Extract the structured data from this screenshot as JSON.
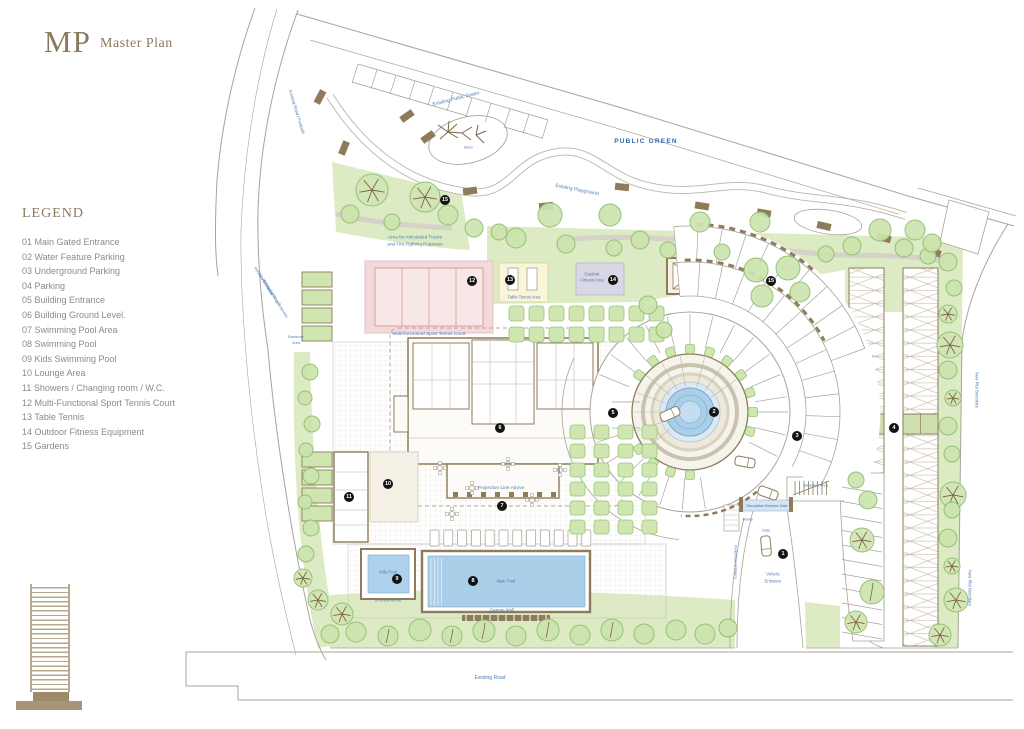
{
  "header": {
    "logo": "MP",
    "title": "Master Plan"
  },
  "legend": {
    "title": "LEGEND",
    "items": [
      "01 Main Gated Entrance",
      "02 Water Feature Parking",
      "03 Underground Parking",
      "04 Parking",
      "05 Building Entrance",
      "06 Building Ground Level.",
      "07 Swimming Pool Area",
      "08 Swimming Pool",
      "09 Kids Swimming Pool",
      "10 Lounge Area",
      "11 Showers / Changing room / W.C.",
      "12 Multi-Functional Sport Tennis Court",
      "13 Table Tennis",
      "14 Outdoor Fitness Equipment",
      "15 Gardens"
    ]
  },
  "colors": {
    "brand_brown": "#8a7a5f",
    "label_blue": "#4f7cb5",
    "public_green_blue": "#2f6aa8",
    "garden_green": "#dcebc4",
    "pool_blue": "#a9cfe9",
    "court_pink": "#f3d9d9",
    "wall_brown": "#8d7b5a"
  },
  "plan": {
    "markers": [
      {
        "n": "1",
        "x": 783,
        "y": 554
      },
      {
        "n": "2",
        "x": 714,
        "y": 412
      },
      {
        "n": "3",
        "x": 797,
        "y": 436
      },
      {
        "n": "4",
        "x": 894,
        "y": 428
      },
      {
        "n": "5",
        "x": 613,
        "y": 413
      },
      {
        "n": "6",
        "x": 500,
        "y": 428
      },
      {
        "n": "7",
        "x": 502,
        "y": 506
      },
      {
        "n": "8",
        "x": 473,
        "y": 581
      },
      {
        "n": "9",
        "x": 397,
        "y": 579
      },
      {
        "n": "10",
        "x": 388,
        "y": 484
      },
      {
        "n": "11",
        "x": 349,
        "y": 497
      },
      {
        "n": "12",
        "x": 472,
        "y": 281
      },
      {
        "n": "13",
        "x": 510,
        "y": 280
      },
      {
        "n": "14",
        "x": 613,
        "y": 280
      },
      {
        "n": "15",
        "x": 445,
        "y": 200
      },
      {
        "n": "15",
        "x": 771,
        "y": 281
      }
    ],
    "labels": [
      {
        "t": "PUBLIC GREEN",
        "x": 646,
        "y": 142,
        "s": 6.5,
        "c": "#2f6aa8",
        "b": true,
        "ls": 1.2
      },
      {
        "t": "Existing Public Green",
        "x": 456,
        "y": 99,
        "s": 5,
        "r": -14
      },
      {
        "t": "Existing Playground",
        "x": 577,
        "y": 190,
        "s": 5,
        "r": 11
      },
      {
        "t": "Existing Road / Footpath",
        "x": 297,
        "y": 112,
        "s": 4.2,
        "r": 73
      },
      {
        "t": "Area for Articulated Trucks",
        "x": 415,
        "y": 237,
        "s": 4.6
      },
      {
        "t": "and Fire Fighting Purposes",
        "x": 415,
        "y": 244,
        "s": 4.6
      },
      {
        "t": "Vehicles Entrance",
        "x": 263,
        "y": 281,
        "s": 4,
        "r": 58
      },
      {
        "t": "for Articulated Trucks",
        "x": 269,
        "y": 290,
        "s": 4,
        "r": 58
      },
      {
        "t": "& Fire Fighting Purposes",
        "x": 275,
        "y": 299,
        "s": 4,
        "r": 58
      },
      {
        "t": "Multi-functional Sport Tennis Court",
        "x": 429,
        "y": 335,
        "s": 4.8
      },
      {
        "t": "Table Tennis Area",
        "x": 524,
        "y": 297,
        "s": 4.2
      },
      {
        "t": "Outdoor",
        "x": 592,
        "y": 274,
        "s": 4.2
      },
      {
        "t": "Fitness Area",
        "x": 592,
        "y": 280,
        "s": 4.2
      },
      {
        "t": "Projection Line Above",
        "x": 501,
        "y": 489,
        "s": 4.8
      },
      {
        "t": "Kids Pool",
        "x": 388,
        "y": 572,
        "s": 4.2
      },
      {
        "t": "Umbrella Above",
        "x": 388,
        "y": 601,
        "s": 3.8
      },
      {
        "t": "Main Pool",
        "x": 506,
        "y": 581,
        "s": 4.2
      },
      {
        "t": "Feature Wall",
        "x": 502,
        "y": 610,
        "s": 4.2
      },
      {
        "t": "Existing Road",
        "x": 490,
        "y": 678,
        "s": 5
      },
      {
        "t": "New Plot Boundary",
        "x": 977,
        "y": 390,
        "s": 4.2,
        "r": 90
      },
      {
        "t": "New Plot Boundary",
        "x": 970,
        "y": 588,
        "s": 4.2,
        "r": 90
      },
      {
        "t": "Bicycles Area",
        "x": 816,
        "y": 486,
        "s": 4
      },
      {
        "t": "Decorative Entrance Gate",
        "x": 767,
        "y": 506,
        "s": 3.6,
        "c": "#3a6ea8"
      },
      {
        "t": "Ramp",
        "x": 748,
        "y": 520,
        "s": 3.8
      },
      {
        "t": "Gate",
        "x": 766,
        "y": 531,
        "s": 3.8
      },
      {
        "t": "Vehicle",
        "x": 773,
        "y": 574,
        "s": 4.2
      },
      {
        "t": "Entrance",
        "x": 773,
        "y": 581,
        "s": 4.2
      },
      {
        "t": "Pedestrian Entrance",
        "x": 735,
        "y": 562,
        "s": 3.8,
        "r": 90
      },
      {
        "t": "Sand",
        "x": 468,
        "y": 148,
        "s": 3.8
      },
      {
        "t": "Barbecue",
        "x": 296,
        "y": 337,
        "s": 3.6
      },
      {
        "t": "Area",
        "x": 296,
        "y": 343,
        "s": 3.6
      }
    ]
  }
}
